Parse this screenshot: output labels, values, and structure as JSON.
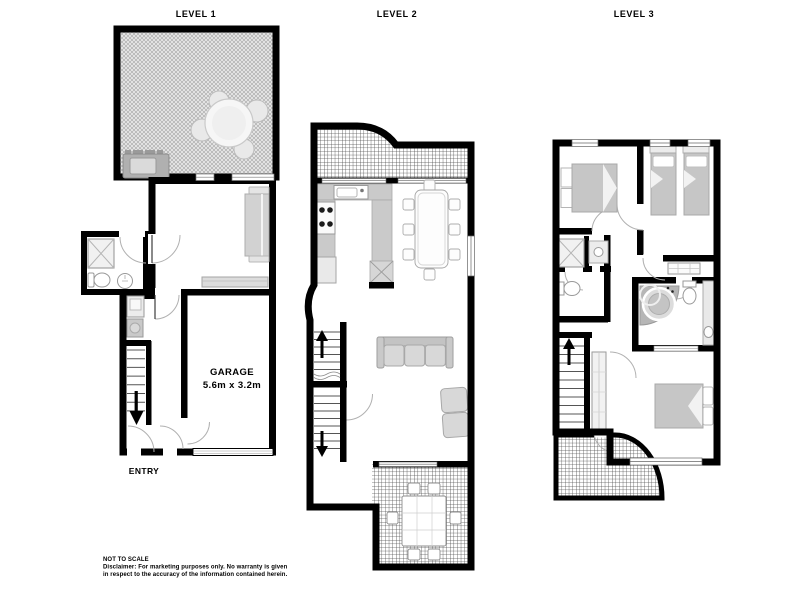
{
  "header": {
    "levels": [
      {
        "label": "LEVEL 1"
      },
      {
        "label": "LEVEL 2"
      },
      {
        "label": "LEVEL 3"
      }
    ]
  },
  "annotations": {
    "garage_name": "GARAGE",
    "garage_dims": "5.6m x 3.2m",
    "entry": "ENTRY"
  },
  "footer": {
    "scale_note": "NOT TO SCALE",
    "disclaimer_line1": "Disclaimer: For marketing purposes only.  No warranty is given",
    "disclaimer_line2": "in respect to the accuracy of the information contained herein."
  },
  "colors": {
    "background": "#ffffff",
    "walls": "#000000",
    "outdoor_grid_hatch": "#4a4a4a",
    "courtyard_weave_hatch": "#b5b5b5",
    "furniture_gray": "#d2d2d2",
    "kitchen_counter": "#cacaca",
    "text": "#000000"
  }
}
